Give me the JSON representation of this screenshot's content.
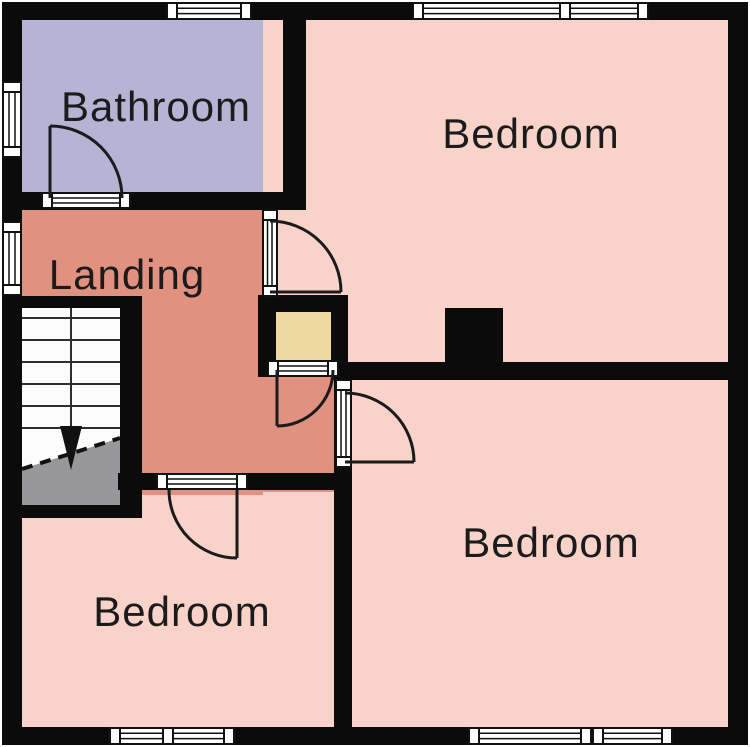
{
  "plan": {
    "type": "floor-plan",
    "rooms": {
      "bathroom": {
        "label": "Bathroom",
        "color": "#b6b4d5"
      },
      "landing": {
        "label": "Landing",
        "color": "#e19180"
      },
      "bedroom_ne": {
        "label": "Bedroom",
        "color": "#f9d3ca"
      },
      "bedroom_sw": {
        "label": "Bedroom",
        "color": "#f9d3ca"
      },
      "bedroom_se": {
        "label": "Bedroom",
        "color": "#f9d3ca"
      },
      "closet": {
        "color": "#eed9a3"
      }
    },
    "stairs": {
      "tread_color": "#fcfcfc",
      "under_color": "#98989a",
      "arrow_icon": "down-arrow"
    },
    "colors": {
      "wall": "#0b0b0b",
      "line": "#1b1b1b",
      "label": "#1b1b1b",
      "opening_fill": "#ffffff",
      "background": "#ffffff"
    }
  }
}
